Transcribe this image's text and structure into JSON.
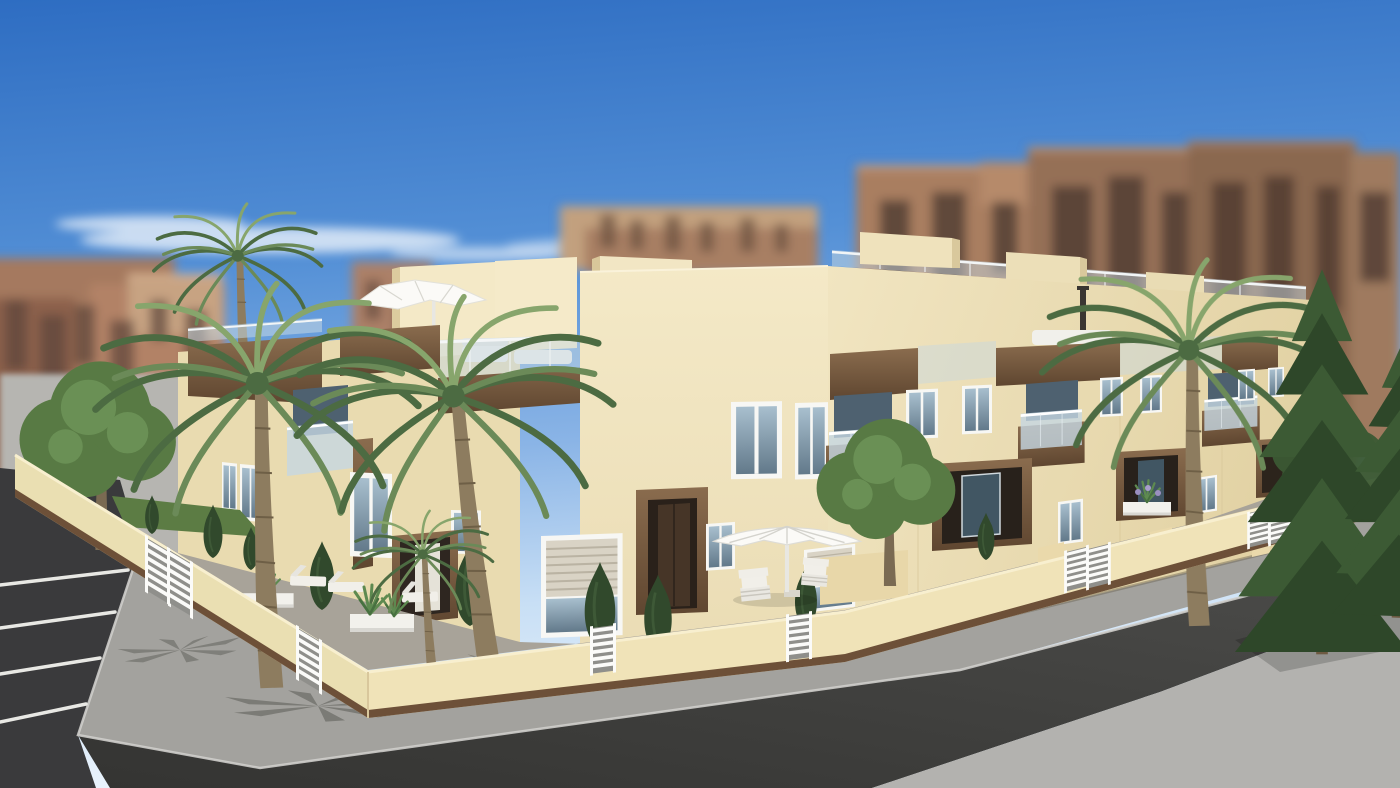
{
  "scene": {
    "type": "3d-architectural-render",
    "setting": "new-build two-storey townhouse development on a street corner",
    "lighting": "clear sunny day, blue sky with thin wispy clouds",
    "camera": "elevated three-quarter corner view",
    "foreground": "dark asphalt street corner with white-striped parking bays and light concrete sidewalks",
    "midground": "cream stucco townhouses with wood-clad fascias, glass balconies, roof terraces, white parasols, walled front yards with palms, shrubs, planters and outdoor furniture",
    "background": "blurred salmon and brown high-rise apartment blocks"
  },
  "objects": [
    "sky",
    "clouds",
    "background apartment towers",
    "plaza ground",
    "parking bays",
    "sidewalk",
    "asphalt road",
    "townhouse left facade",
    "corner facade",
    "right facade",
    "stair towers",
    "roof terrace",
    "rooftop umbrella",
    "wood fascia bands",
    "glass balconies",
    "windows",
    "roller-shutter windows",
    "entrance portal",
    "porches",
    "perimeter wall",
    "white louvre gates",
    "palm trees",
    "garden trees",
    "conifers",
    "cypress bushes",
    "planter boxes",
    "agave plants",
    "patio parasol",
    "armchairs",
    "loungers",
    "grass strip"
  ],
  "colors": {
    "sky_top": "#2e6dc2",
    "sky_mid": "#5490d6",
    "sky_low": "#8ab4e6",
    "sky_pale": "#c8dff5",
    "sky_horizon": "#eaf3fc",
    "cloud": "#ffffff",
    "bg_salmon": "#a5795f",
    "bg_salmon2": "#b28266",
    "bg_tan": "#c7a382",
    "bg_brown": "#8a6750",
    "bg_window": "#4a372e",
    "plaza": "#b6b5b1",
    "facade_light": "#f4e9c7",
    "facade_mid": "#eadcb4",
    "facade_dark": "#d9c79c",
    "wood_light": "#8a6c4e",
    "wood_dark": "#5f4630",
    "glass_light": "#a8bfce",
    "glass_deep": "#62798a",
    "glass_rail": "#c5d7e2",
    "glass_window_dark": "#4e6170",
    "white_trim": "#f7f7f4",
    "shutter": "#d9d3c5",
    "door_recess": "#2a211a",
    "door_leaf": "#463527",
    "wall_left": "#eadfb2",
    "wall_right": "#f0e3b8",
    "wall_cap": "#f8efcf",
    "wall_plinth": "#6d5038",
    "gate_slat": "#fbfbf9",
    "gate_gap": "#8f8f8b",
    "sidewalk": "#a3a29e",
    "sidewalk_far": "#b3b2af",
    "curb": "#cfcecb",
    "asphalt": "#3a3a3c",
    "road_light": "#4c4c4a",
    "road_dark": "#343432",
    "line_white": "#e8e8e4",
    "courtyard": "#a8a399",
    "grass": "#5c7c44",
    "palm_frond": "#6b8a58",
    "palm_frond_dark": "#4c6b42",
    "palm_frond_light": "#87a56c",
    "palm_trunk": "#8d7c5f",
    "palm_trunk_dark": "#6e5f46",
    "conifer": "#3c5a34",
    "conifer_dark": "#2e4729",
    "tree_green": "#587a44",
    "tree_green_light": "#6f965a",
    "bush": "#31492c",
    "planter": "#f2f1ec",
    "furniture_white": "#f1efe9",
    "umbrella_white": "#fbfaf7",
    "shadow": "#54544e"
  }
}
